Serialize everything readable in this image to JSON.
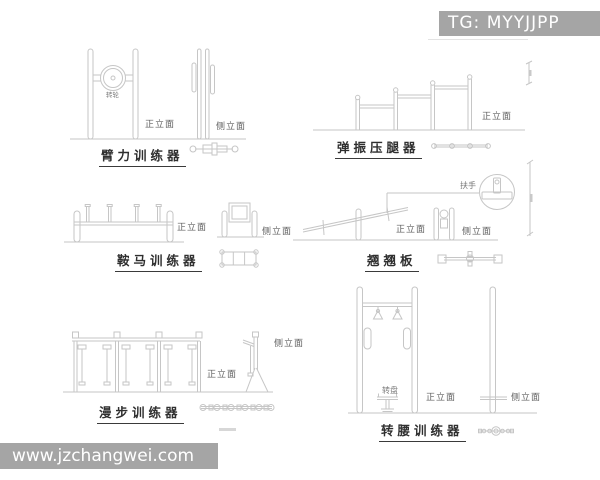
{
  "watermark_top": {
    "text": "TG: MYYJJPP",
    "bg": "#a5a5a5",
    "color": "#ffffff"
  },
  "watermark_bottom": {
    "text": "www.jzchangwei.com",
    "bg": "#a5a5a5",
    "color": "#ffffff"
  },
  "colors": {
    "line": "#c6c6c6",
    "label": "#5f5f5f",
    "title": "#2f2f2f"
  },
  "drawings": {
    "arm_trainer": {
      "title": "臂力训练器",
      "front_label": "正立面",
      "side_label": "侧立面",
      "part_label": "转轮"
    },
    "leg_press": {
      "title": "弹振压腿器",
      "front_label": "正立面"
    },
    "pommel_horse": {
      "title": "鞍马训练器",
      "front_label": "正立面",
      "side_label": "侧立面"
    },
    "seesaw": {
      "title": "翘翘板",
      "front_label": "正立面",
      "side_label": "侧立面",
      "part_label": "扶手"
    },
    "walker": {
      "title": "漫步训练器",
      "front_label": "正立面",
      "side_label": "侧立面"
    },
    "waist_twister": {
      "title": "转腰训练器",
      "front_label": "正立面",
      "side_label": "侧立面",
      "part_label": "转盘"
    }
  }
}
